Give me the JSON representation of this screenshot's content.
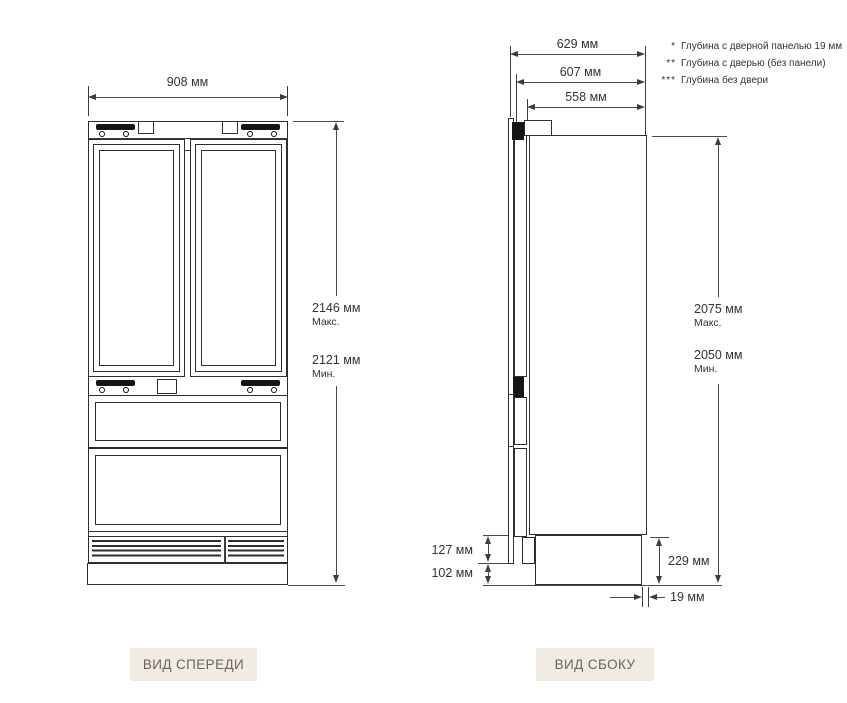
{
  "front_view": {
    "caption": "ВИД СПЕРЕДИ",
    "width_label": "908 мм",
    "height_max": "2146 мм",
    "height_max_note": "Макс.",
    "height_min": "2121 мм",
    "height_min_note": "Мин."
  },
  "side_view": {
    "caption": "ВИД СБОКУ",
    "depth_with_panel": "629 мм",
    "depth_with_door": "607 мм",
    "depth_without_door": "558 мм",
    "height_max": "2075 мм",
    "height_max_note": "Макс.",
    "height_min": "2050 мм",
    "height_min_note": "Мин.",
    "dim_door_below": "127 мм",
    "dim_plinth": "102 мм",
    "dim_base": "229 мм",
    "dim_panel_thickness": "19 мм"
  },
  "notes": [
    {
      "marker": "*",
      "text": "Глубина с дверной панелью 19 мм"
    },
    {
      "marker": "**",
      "text": "Глубина с дверью (без панели)"
    },
    {
      "marker": "***",
      "text": "Глубина без двери"
    }
  ],
  "colors": {
    "line": "#3c3c3c",
    "caption_bg": "#f0ece4",
    "caption_text": "#6e6459"
  }
}
